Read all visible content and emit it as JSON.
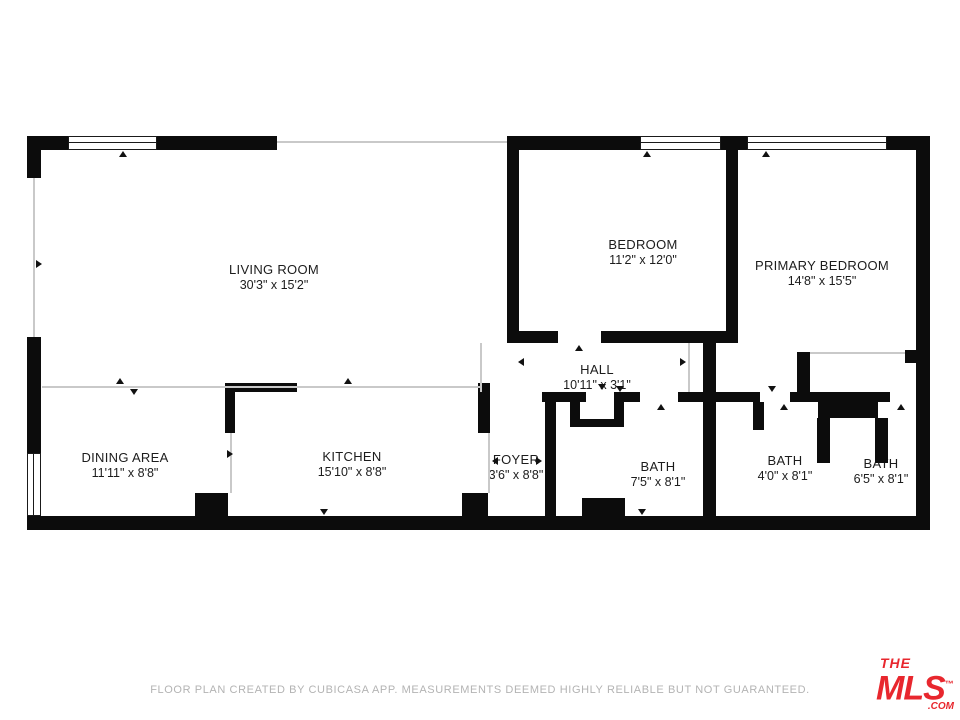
{
  "title": "Floor Plan",
  "rooms": [
    {
      "name": "LIVING ROOM",
      "dims": "30'3\" x 15'2\""
    },
    {
      "name": "BEDROOM",
      "dims": "11'2\" x 12'0\""
    },
    {
      "name": "PRIMARY BEDROOM",
      "dims": "14'8\" x 15'5\""
    },
    {
      "name": "HALL",
      "dims": "10'11\" x 3'1\""
    },
    {
      "name": "DINING AREA",
      "dims": "11'11\" x 8'8\""
    },
    {
      "name": "KITCHEN",
      "dims": "15'10\" x 8'8\""
    },
    {
      "name": "FOYER",
      "dims": "3'6\" x 8'8\""
    },
    {
      "name": "BATH",
      "dims": "7'5\" x 8'1\""
    },
    {
      "name": "BATH",
      "dims": "4'0\" x 8'1\""
    },
    {
      "name": "BATH",
      "dims": "6'5\" x 8'1\""
    }
  ],
  "footer": {
    "disclaimer": "FLOOR PLAN CREATED BY CUBICASA APP. MEASUREMENTS DEEMED HIGHLY RELIABLE BUT NOT GUARANTEED."
  },
  "logo": {
    "line1": "THE",
    "line2": "MLS",
    "tm": "™",
    "line3": ".COM",
    "color": "#e8272e"
  },
  "colors": {
    "wall": "#0c0c0c",
    "open_boundary": "#c9c9c9",
    "label_text": "#1c1c1c",
    "footer_text": "#b3b3b3",
    "logo_red": "#e8272e"
  }
}
